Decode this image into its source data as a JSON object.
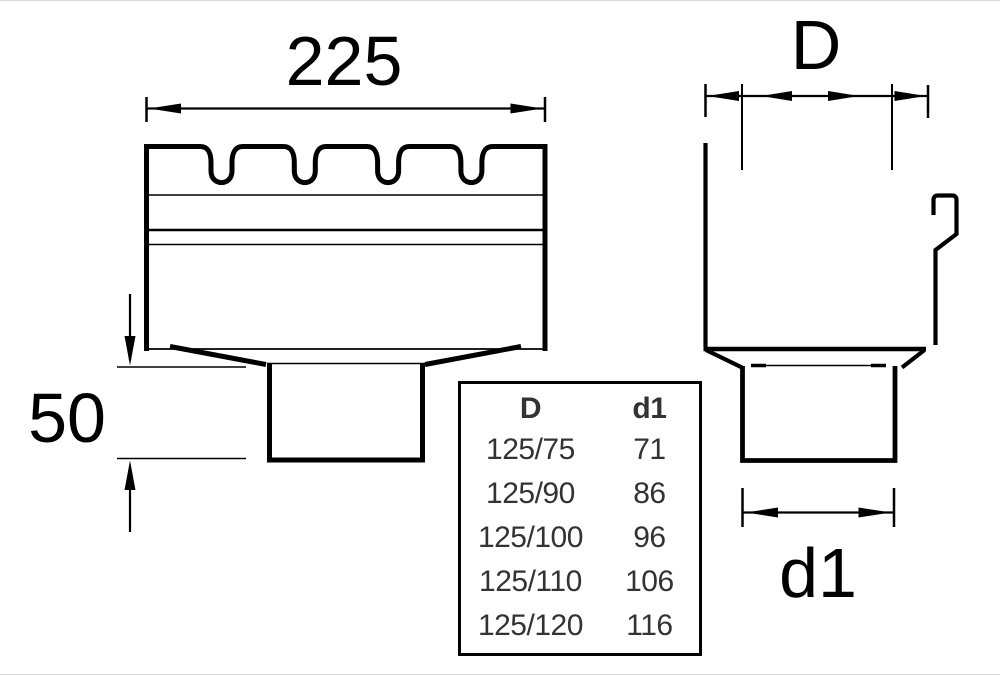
{
  "labels": {
    "front_width": "225",
    "front_outlet_height": "50",
    "side_top_width": "D",
    "side_outlet_width": "d1"
  },
  "table": {
    "col_d_header": "D",
    "col_d1_header": "d1",
    "rows": [
      {
        "d": "125/75",
        "d1": "71"
      },
      {
        "d": "125/90",
        "d1": "86"
      },
      {
        "d": "125/100",
        "d1": "96"
      },
      {
        "d": "125/110",
        "d1": "106"
      },
      {
        "d": "125/120",
        "d1": "116"
      }
    ]
  },
  "colors": {
    "line": "#000000",
    "background": "#ffffff",
    "table_text": "#333333"
  }
}
